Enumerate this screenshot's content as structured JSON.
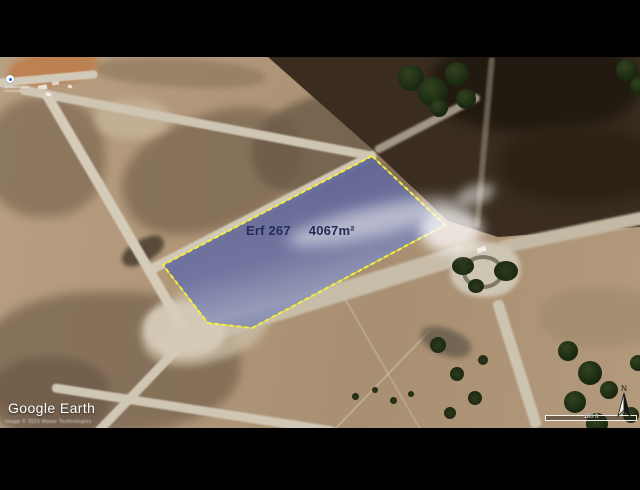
{
  "parcel": {
    "name": "Erf 267",
    "area": "4067m²",
    "fill_color": "#636896",
    "border_color": "#f3ef3e",
    "label_color": "#222c55"
  },
  "branding": {
    "logo": "Google Earth",
    "attribution": "Image © 2023 Maxar Technologies"
  },
  "map_controls": {
    "scale_label": "100 ft",
    "north_label": "N"
  }
}
